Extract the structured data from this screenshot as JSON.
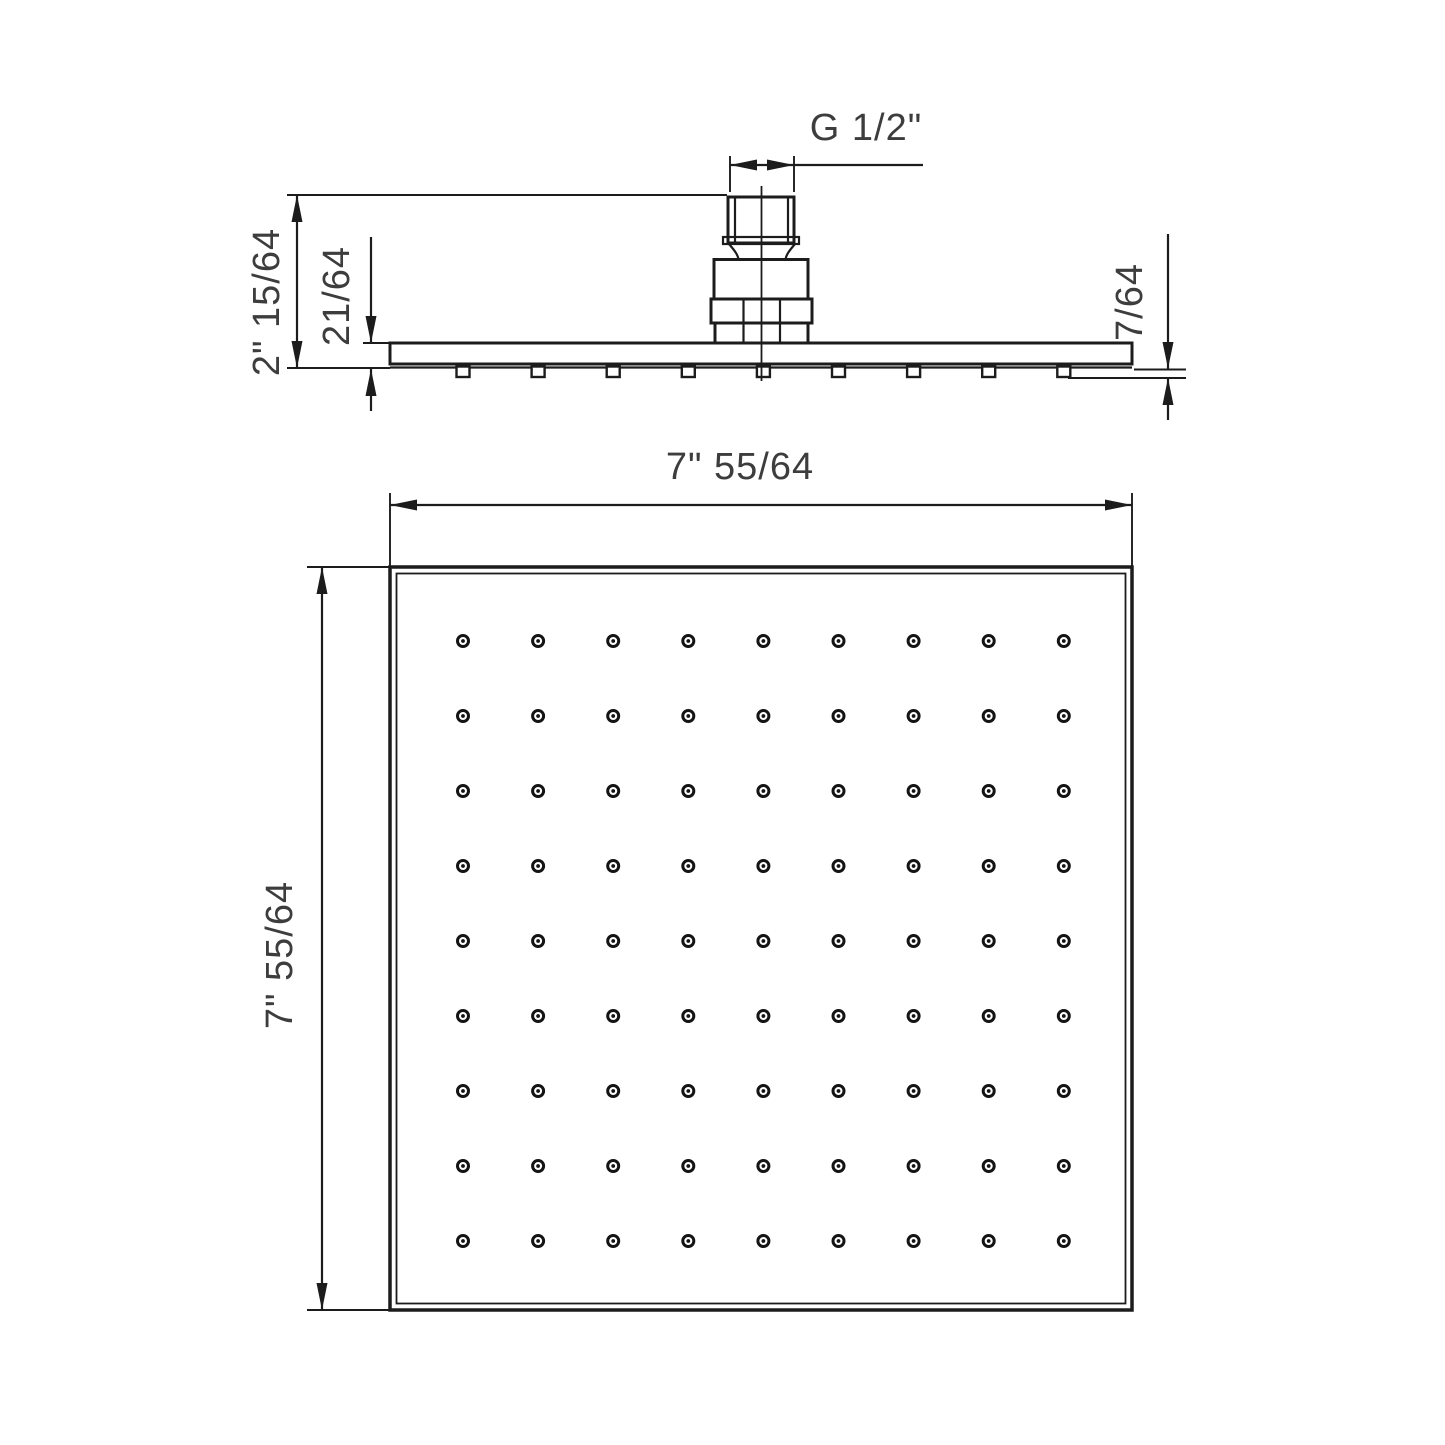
{
  "side_view": {
    "thread_size_label": "G 1/2\"",
    "overall_height_label": "2\" 15/64",
    "plate_thickness_label": "21/64",
    "nozzle_protrusion_label": "7/64",
    "nozzle_count": 9
  },
  "bottom_view": {
    "width_label": "7\" 55/64",
    "height_label": "7\" 55/64",
    "nozzle_grid": {
      "rows": 9,
      "columns": 9
    }
  },
  "colors": {
    "line": "#1c1c1c",
    "text": "#3d3d3d",
    "background": "#ffffff"
  }
}
